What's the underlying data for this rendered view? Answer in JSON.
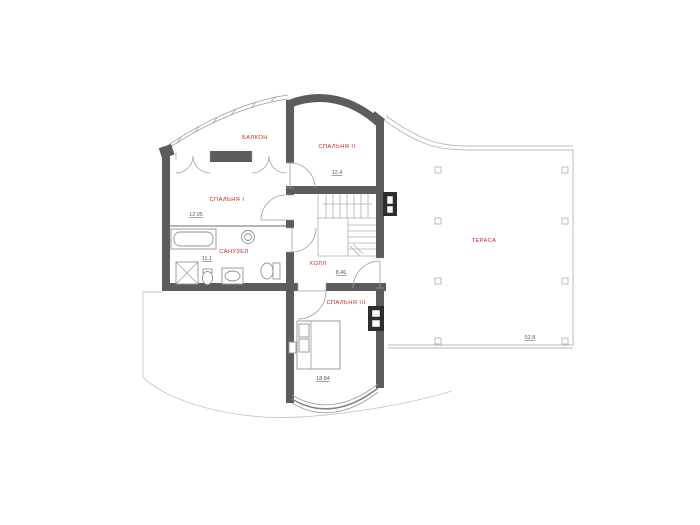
{
  "plan": {
    "title": "second-floor-plan",
    "rooms": [
      {
        "id": "balcony",
        "label": "БАЛКОН",
        "area": ""
      },
      {
        "id": "bedroom2",
        "label": "СПАЛЬНЯ II",
        "area": "12.4"
      },
      {
        "id": "bedroom1",
        "label": "СПАЛЬНЯ I",
        "area": "12.05"
      },
      {
        "id": "bathroom",
        "label": "САНУЗЕЛ",
        "area": "11.1"
      },
      {
        "id": "hall",
        "label": "ХОЛЛ",
        "area": "8.46"
      },
      {
        "id": "bedroom3",
        "label": "СПАЛЬНЯ III",
        "area": "18.84"
      },
      {
        "id": "terrace",
        "label": "ТЕРАСА",
        "area": "52.8"
      }
    ],
    "colors": {
      "wall": "#5c5c5c",
      "room_label": "#cc2020",
      "area_number": "#5a5a5a",
      "thin_line": "#9aa0a6",
      "background": "#ffffff"
    }
  }
}
